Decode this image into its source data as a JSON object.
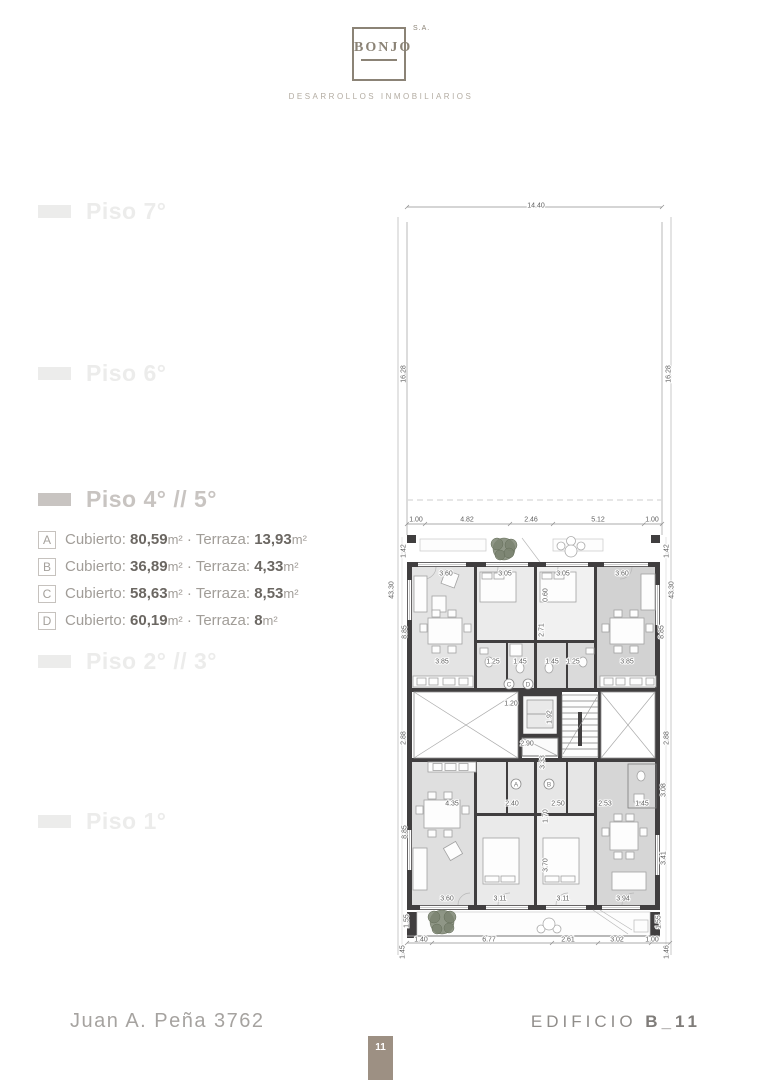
{
  "logo": {
    "name": "BONJO",
    "suffix": "S.A.",
    "tagline": "DESARROLLOS INMOBILIARIOS"
  },
  "sidebar": {
    "floors": [
      {
        "label": "Piso 7°",
        "active": false
      },
      {
        "label": "Piso 6°",
        "active": false
      },
      {
        "label": "Piso 4° // 5°",
        "active": true
      },
      {
        "label": "Piso 2° // 3°",
        "active": false
      },
      {
        "label": "Piso 1°",
        "active": false
      }
    ],
    "units": [
      {
        "letter": "A",
        "area_label": "Cubierto:",
        "area": "80,59",
        "area_unit": "m²",
        "sep": "·",
        "terrace_label": "Terraza:",
        "terrace": "13,93",
        "terrace_unit": "m²"
      },
      {
        "letter": "B",
        "area_label": "Cubierto:",
        "area": "36,89",
        "area_unit": "m²",
        "sep": "·",
        "terrace_label": "Terraza:",
        "terrace": "4,33",
        "terrace_unit": "m²"
      },
      {
        "letter": "C",
        "area_label": "Cubierto:",
        "area": "58,63",
        "area_unit": "m²",
        "sep": "·",
        "terrace_label": "Terraza:",
        "terrace": "8,53",
        "terrace_unit": "m²"
      },
      {
        "letter": "D",
        "area_label": "Cubierto:",
        "area": "60,19",
        "area_unit": "m²",
        "sep": "·",
        "terrace_label": "Terraza:",
        "terrace": "8",
        "terrace_unit": "m²"
      }
    ]
  },
  "plan": {
    "dimension_labels": [
      {
        "t": "14.40",
        "x": 536,
        "y": 205,
        "r": 0
      },
      {
        "t": "16.28",
        "x": 403,
        "y": 374,
        "r": -90
      },
      {
        "t": "16.28",
        "x": 668,
        "y": 374,
        "r": -90
      },
      {
        "t": "1.00",
        "x": 416,
        "y": 519,
        "r": 0
      },
      {
        "t": "4.82",
        "x": 467,
        "y": 519,
        "r": 0
      },
      {
        "t": "2.46",
        "x": 531,
        "y": 519,
        "r": 0
      },
      {
        "t": "5.12",
        "x": 598,
        "y": 519,
        "r": 0
      },
      {
        "t": "1.00",
        "x": 652,
        "y": 519,
        "r": 0
      },
      {
        "t": "1.42",
        "x": 403,
        "y": 551,
        "r": -90
      },
      {
        "t": "1.42",
        "x": 666,
        "y": 551,
        "r": -90
      },
      {
        "t": "43.30",
        "x": 391,
        "y": 590,
        "r": -90
      },
      {
        "t": "43.30",
        "x": 671,
        "y": 590,
        "r": -90
      },
      {
        "t": "3.60",
        "x": 446,
        "y": 573,
        "r": 0
      },
      {
        "t": "3.05",
        "x": 505,
        "y": 573,
        "r": 0
      },
      {
        "t": "3.05",
        "x": 563,
        "y": 573,
        "r": 0
      },
      {
        "t": "3.60",
        "x": 622,
        "y": 573,
        "r": 0
      },
      {
        "t": "0.60",
        "x": 545,
        "y": 595,
        "r": -90
      },
      {
        "t": "2.71",
        "x": 541,
        "y": 630,
        "r": -90
      },
      {
        "t": "8.85",
        "x": 404,
        "y": 632,
        "r": -90
      },
      {
        "t": "8.85",
        "x": 661,
        "y": 632,
        "r": -90
      },
      {
        "t": "3.85",
        "x": 442,
        "y": 661,
        "r": 0
      },
      {
        "t": "1.25",
        "x": 493,
        "y": 661,
        "r": 0
      },
      {
        "t": "1.45",
        "x": 520,
        "y": 661,
        "r": 0
      },
      {
        "t": "1.45",
        "x": 552,
        "y": 661,
        "r": 0
      },
      {
        "t": "1.25",
        "x": 573,
        "y": 661,
        "r": 0
      },
      {
        "t": "3.85",
        "x": 627,
        "y": 661,
        "r": 0
      },
      {
        "t": "1.20",
        "x": 511,
        "y": 703,
        "r": 0
      },
      {
        "t": "1.92",
        "x": 549,
        "y": 717,
        "r": -90
      },
      {
        "t": "2.90",
        "x": 527,
        "y": 743,
        "r": 0
      },
      {
        "t": "3.33",
        "x": 542,
        "y": 762,
        "r": -90
      },
      {
        "t": "2.88",
        "x": 403,
        "y": 738,
        "r": -90
      },
      {
        "t": "2.88",
        "x": 666,
        "y": 738,
        "r": -90
      },
      {
        "t": "4.35",
        "x": 452,
        "y": 803,
        "r": 0
      },
      {
        "t": "2.40",
        "x": 512,
        "y": 803,
        "r": 0
      },
      {
        "t": "2.50",
        "x": 558,
        "y": 803,
        "r": 0
      },
      {
        "t": "2.53",
        "x": 605,
        "y": 803,
        "r": 0
      },
      {
        "t": "1.45",
        "x": 642,
        "y": 803,
        "r": 0
      },
      {
        "t": "1.70",
        "x": 545,
        "y": 816,
        "r": -90
      },
      {
        "t": "3.08",
        "x": 663,
        "y": 790,
        "r": -90
      },
      {
        "t": "3.70",
        "x": 545,
        "y": 865,
        "r": -90
      },
      {
        "t": "8.85",
        "x": 404,
        "y": 832,
        "r": -90
      },
      {
        "t": "3.41",
        "x": 663,
        "y": 858,
        "r": -90
      },
      {
        "t": "3.60",
        "x": 447,
        "y": 898,
        "r": 0
      },
      {
        "t": "3.11",
        "x": 500,
        "y": 898,
        "r": 0
      },
      {
        "t": "3.11",
        "x": 563,
        "y": 898,
        "r": 0
      },
      {
        "t": "3.94",
        "x": 623,
        "y": 898,
        "r": 0
      },
      {
        "t": "1.55",
        "x": 406,
        "y": 921,
        "r": -90
      },
      {
        "t": "1.55",
        "x": 658,
        "y": 922,
        "r": -90
      },
      {
        "t": "1.40",
        "x": 421,
        "y": 939,
        "r": 0
      },
      {
        "t": "6.77",
        "x": 489,
        "y": 939,
        "r": 0
      },
      {
        "t": "2.61",
        "x": 568,
        "y": 939,
        "r": 0
      },
      {
        "t": "3.02",
        "x": 617,
        "y": 939,
        "r": 0
      },
      {
        "t": "1.00",
        "x": 652,
        "y": 939,
        "r": 0
      },
      {
        "t": "1.45",
        "x": 402,
        "y": 952,
        "r": -90
      },
      {
        "t": "1.46",
        "x": 666,
        "y": 952,
        "r": -90
      }
    ],
    "unit_markers": [
      {
        "letter": "C",
        "x": 509,
        "y": 684
      },
      {
        "letter": "D",
        "x": 528,
        "y": 684
      },
      {
        "letter": "A",
        "x": 516,
        "y": 784
      },
      {
        "letter": "B",
        "x": 549,
        "y": 784
      }
    ],
    "colors": {
      "wall": "#403e3f",
      "room_light": "#e4e4e4",
      "room_dark": "#d3d3d3",
      "tree": "#7b8471",
      "accent_tab": "#9d9083"
    }
  },
  "footer": {
    "address": "Juan A. Peña 3762",
    "building_label": "EDIFICIO",
    "building_code": "B_11",
    "page_number": "11"
  }
}
